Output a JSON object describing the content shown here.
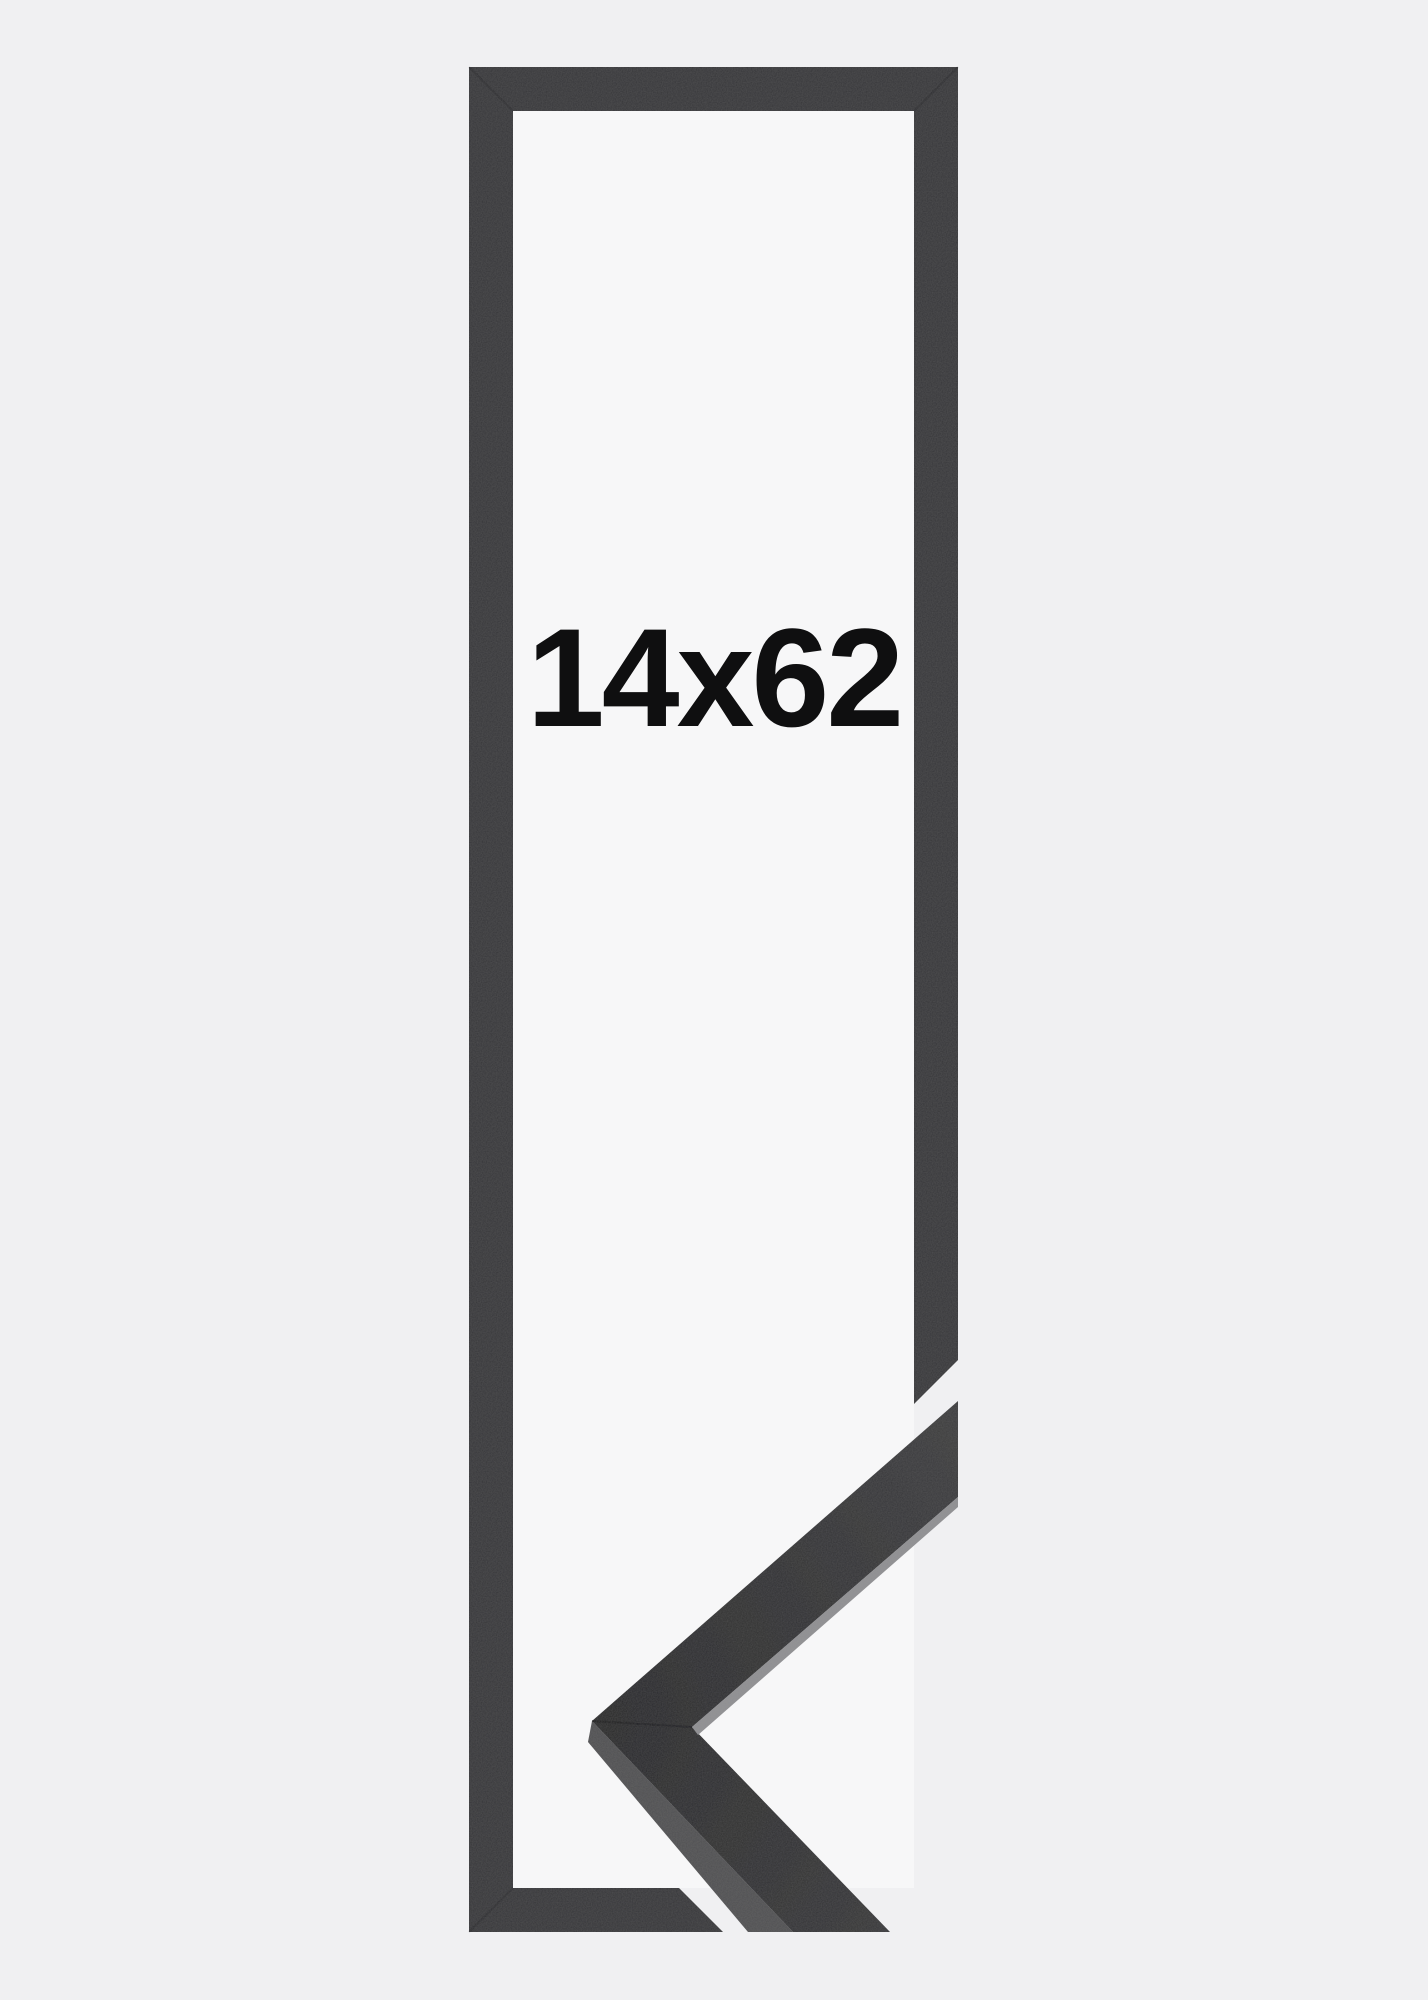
{
  "page": {
    "background_color": "#f0f0f2"
  },
  "product": {
    "size_label": "14x62",
    "label_color": "#0f0f10",
    "outline_color": "#37373a",
    "interior_color": "#f7f7f8",
    "moulding": {
      "top_face_dark": "#29292b",
      "top_face_light": "#3e3e40",
      "side_face_color": "#515153",
      "edge_highlight_color": "#8f8f92"
    }
  }
}
